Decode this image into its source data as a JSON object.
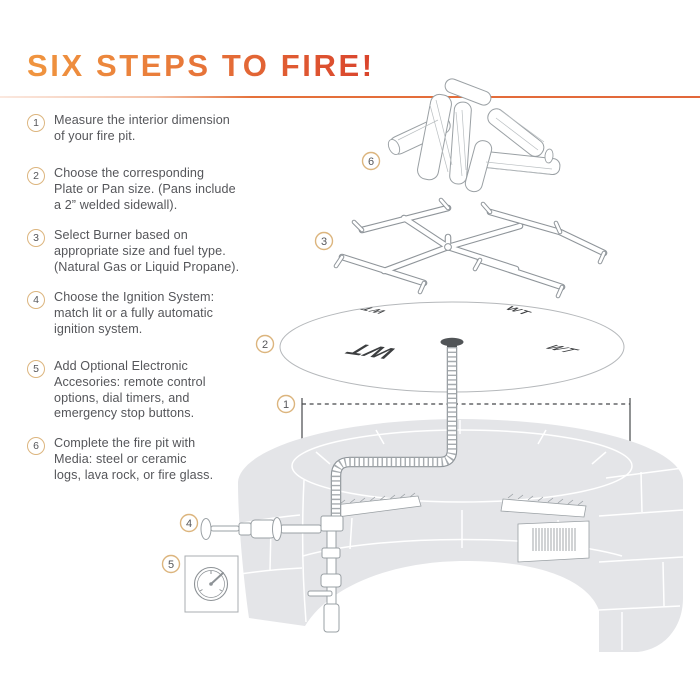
{
  "title": "SIX STEPS TO FIRE!",
  "steps": [
    {
      "number": "1",
      "lines": [
        "Measure the interior dimension",
        "of your fire pit."
      ]
    },
    {
      "number": "2",
      "lines": [
        "Choose the corresponding",
        "Plate or Pan size. (Pans include",
        "a 2” welded sidewall)."
      ]
    },
    {
      "number": "3",
      "lines": [
        "Select Burner based on",
        "appropriate size and fuel type.",
        "(Natural Gas or Liquid Propane)."
      ]
    },
    {
      "number": "4",
      "lines": [
        "Choose the Ignition System:",
        "match lit or a fully automatic",
        "ignition system."
      ]
    },
    {
      "number": "5",
      "lines": [
        "Add Optional Electronic",
        "Accesories: remote control",
        "options, dial timers, and",
        "emergency stop buttons."
      ]
    },
    {
      "number": "6",
      "lines": [
        "Complete the fire pit with",
        "Media: steel or ceramic",
        "logs, lava rock, or fire glass."
      ]
    }
  ],
  "diagram": {
    "badge_labels": {
      "measurement": "1",
      "plate": "2",
      "burner": "3",
      "valve": "4",
      "timer": "5",
      "media": "6"
    },
    "plate_marks": [
      "WT",
      "WT",
      "WT",
      "WT"
    ],
    "colors": {
      "title_gradient_start": "#F0953F",
      "title_gradient_end": "#D9432C",
      "title_rule": "#E5713A",
      "badge_ring": "#DCB57E",
      "step_text": "#55565A",
      "pit_gray": "#E4E5E8",
      "line_art": "#9AA0A4"
    }
  }
}
